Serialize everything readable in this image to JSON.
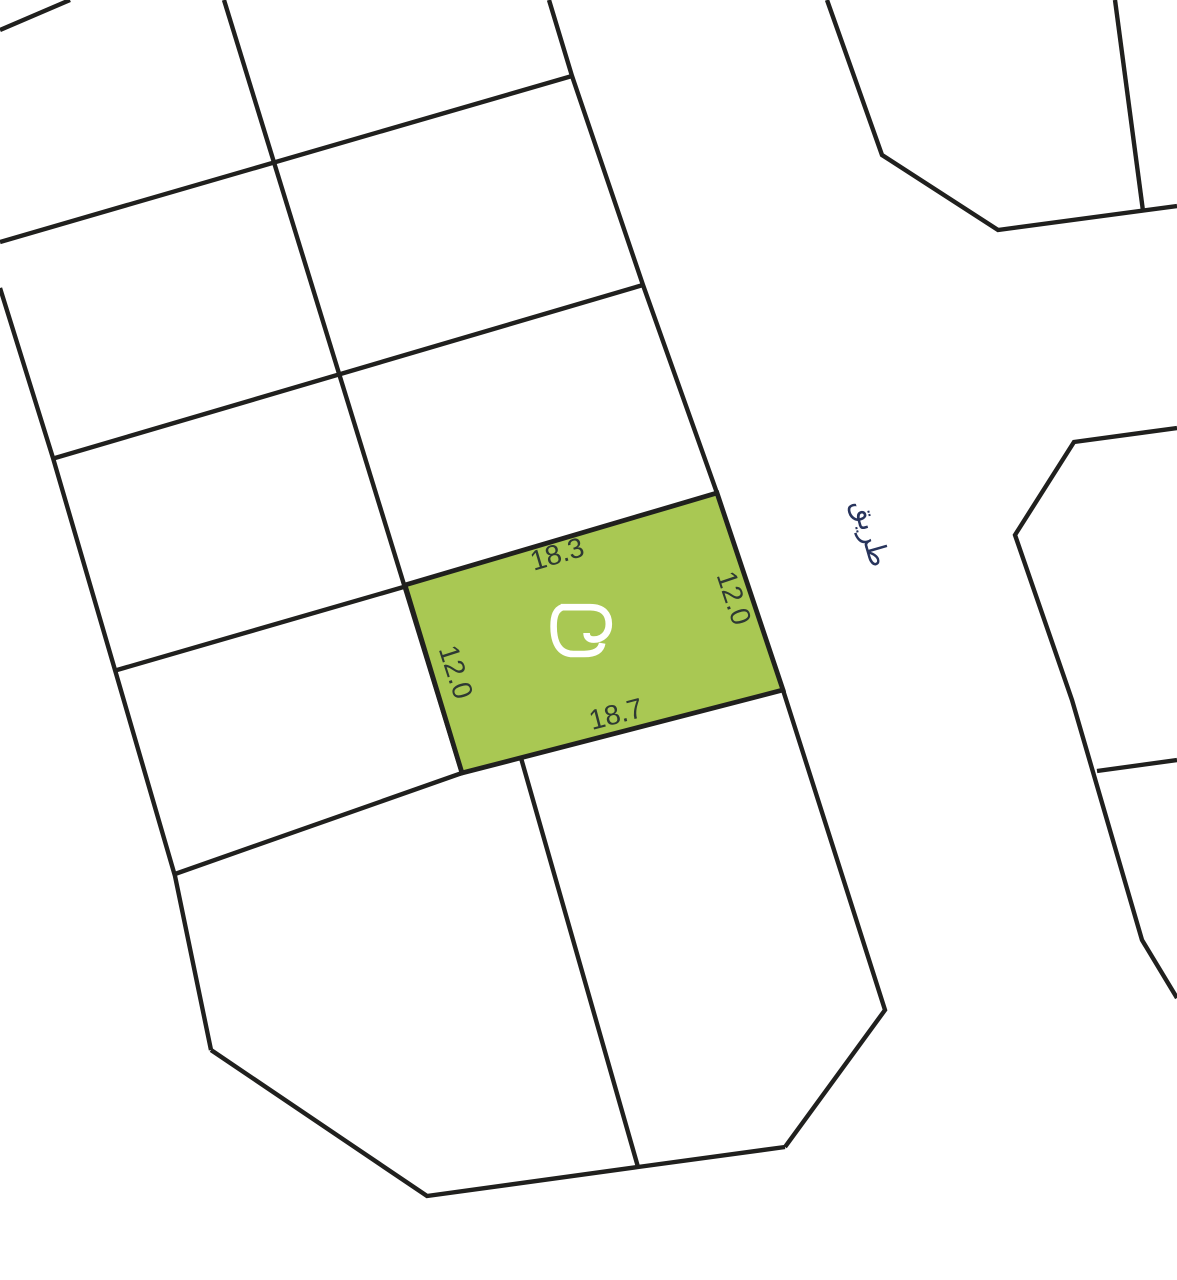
{
  "map": {
    "background": "#ffffff",
    "line_color": "#20201e",
    "parcel_lines": [
      {
        "name": "top-left-corner-cut",
        "d": "M 0,30 L 70,0"
      },
      {
        "name": "column-divider",
        "d": "M 224,0 L 462,773"
      },
      {
        "name": "row-divider-1",
        "d": "M 0,242 L 572,76"
      },
      {
        "name": "row-divider-2",
        "d": "M 55,458 L 643,285"
      },
      {
        "name": "row-divider-3",
        "d": "M 117,670 L 407,586"
      },
      {
        "name": "row-divider-4",
        "d": "M 175,874 L 462,773"
      },
      {
        "name": "west-boundary",
        "d": "M 0,288 L 53,458 L 115,670 L 175,876 L 211,1050"
      },
      {
        "name": "south-boundary",
        "d": "M 211,1050 L 427,1196 L 638,1167 L 785,1147"
      },
      {
        "name": "road-west-edge-upper",
        "d": "M 549,0 L 572,76 L 643,285 L 717,493"
      },
      {
        "name": "road-west-edge-lower",
        "d": "M 783,690 L 885,1010 L 785,1147"
      },
      {
        "name": "bottom-parcel-divider",
        "d": "M 521,758 L 638,1167"
      },
      {
        "name": "northeast-parcel-boundary",
        "d": "M 827,0 L 882,155 L 998,230 L 1177,206"
      },
      {
        "name": "northeast-parcel-divider",
        "d": "M 1115,0 L 1143,211"
      },
      {
        "name": "east-parcel-boundary",
        "d": "M 1177,428 L 1074,442 L 1015,535 L 1072,700 L 1142,940 L 1177,998"
      },
      {
        "name": "east-parcel-divider",
        "d": "M 1097,771 L 1177,760"
      }
    ],
    "highlight_parcel": {
      "fill": "#a9c853",
      "points": "405,585 717,493 783,690 462,773",
      "dimension_color": "#2e3933",
      "dimensions": [
        {
          "side": "top",
          "value": "18.3",
          "transform": "translate(557,554) rotate(-16.5)"
        },
        {
          "side": "right",
          "value": "12.0",
          "transform": "translate(734,598) rotate(71.5)"
        },
        {
          "side": "left",
          "value": "12.0",
          "transform": "translate(456,672) rotate(72)"
        },
        {
          "side": "bottom",
          "value": "18.7",
          "transform": "translate(616,714) rotate(-14.5)"
        }
      ],
      "logo": {
        "color": "#ffffff",
        "transform": "translate(553,600) scale(0.6)",
        "stroke_width": "11",
        "paths": [
          "M 13,12 L 62,12 C 84,12 93,24 93,40 C 93,57 81,66 68,66 C 60,66 56,62 56,55",
          "M 16,12 C 5,16 1,26 1,44 C 1,70 10,90 34,90 L 52,90 C 70,90 80,84 82,72"
        ]
      }
    },
    "road_label": {
      "text": "طريق",
      "color": "#28345c",
      "transform": "translate(871,533) rotate(74)"
    }
  }
}
